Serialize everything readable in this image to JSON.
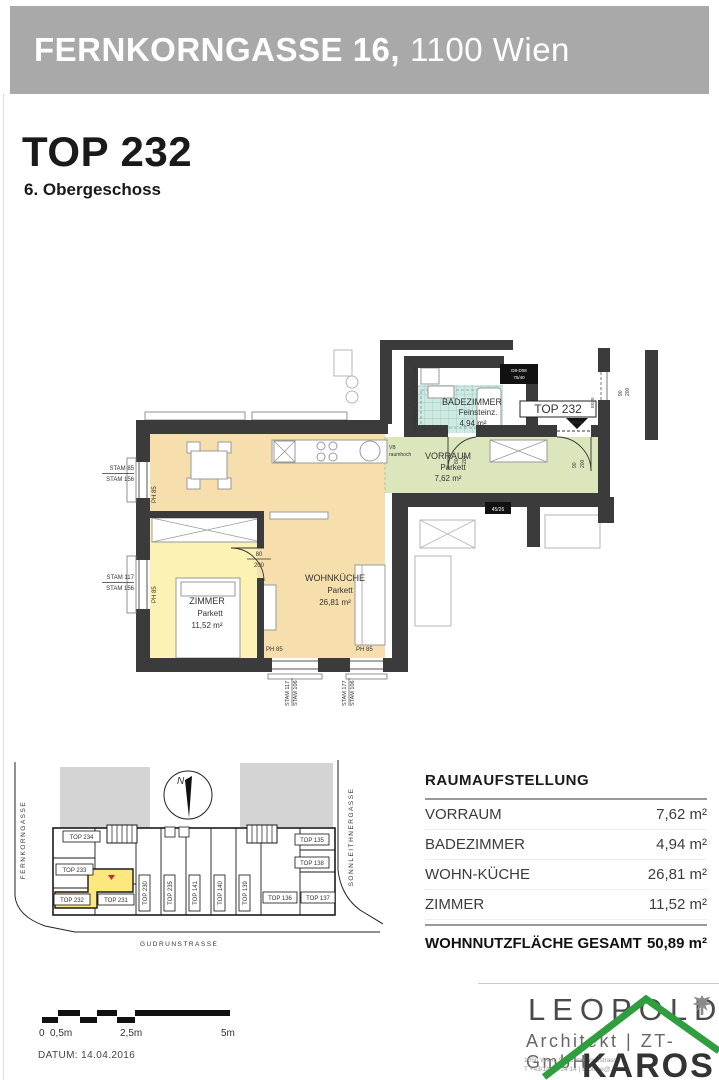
{
  "header": {
    "bar_bold": "FERNKORNGASSE 16,",
    "bar_light": "1100 Wien"
  },
  "title": {
    "unit": "TOP 232",
    "floor": "6. Obergeschoss"
  },
  "floorplan": {
    "rooms": {
      "wohnkueche": {
        "name": "WOHNKÜCHE",
        "finish": "Parkett",
        "area": "26,81 m²"
      },
      "zimmer": {
        "name": "ZIMMER",
        "finish": "Parkett",
        "area": "11,52 m²"
      },
      "vorraum": {
        "name": "VORRAUM",
        "finish": "Parkett",
        "area": "7,62 m²"
      },
      "badezimmer": {
        "name": "BADEZIMMER",
        "finish": "Feinsteinz.",
        "area": "4,94 m²"
      }
    },
    "entrance": {
      "label": "TOP 232",
      "code": "E030"
    },
    "dims": {
      "w80": "80",
      "w90": "90",
      "h200": "200"
    },
    "labels": {
      "stam85": "STAM 85",
      "stam156": "STAM 156",
      "stam117": "STAM 117",
      "stam177": "STAM 177",
      "stam106": "STAM 106",
      "ph85": "PH 85",
      "vb_line1": "VB",
      "vb_line2": "raumhoch",
      "verkleidung": "Verkleidung b=25 cm, UK +19,86",
      "dbox_line1": "D8-D08",
      "dbox_line2": "75/40",
      "shaft": "45/26"
    }
  },
  "siteplan": {
    "streets": {
      "left": "FERNKORNGASSE",
      "right": "SONNLEITHNERGASSE",
      "bottom": "GUDRUNSTRASSE"
    },
    "north": "N",
    "units": [
      "TOP 234",
      "TOP 233",
      "TOP 232",
      "TOP 231",
      "TOP 230",
      "TOP 235",
      "TOP 141",
      "TOP 140",
      "TOP 139",
      "TOP 136",
      "TOP 137",
      "TOP 135",
      "TOP 138"
    ]
  },
  "room_table": {
    "title": "RAUMAUFSTELLUNG",
    "rows": [
      {
        "label": "VORRAUM",
        "area": "7,62 m²"
      },
      {
        "label": "BADEZIMMER",
        "area": "4,94 m²"
      },
      {
        "label": "WOHN-KÜCHE",
        "area": "26,81 m²"
      },
      {
        "label": "ZIMMER",
        "area": "11,52 m²"
      }
    ],
    "total": {
      "label": "WOHNNUTZFLÄCHE GESAMT",
      "area": "50,89 m²"
    }
  },
  "scalebar": {
    "zero": "0",
    "half": "0,5m",
    "mid": "2,5m",
    "full": "5m"
  },
  "footer": {
    "date": "DATUM: 14.04.2016",
    "logo": "LEOPOLD",
    "logo_sub": "Architekt | ZT-GmbH",
    "addr_line1": "1050 Wien,   Schönbrunnerstrasse 2",
    "addr_line2": "T  +43/1/890 24 14   |   E  office@...zt.at",
    "watermark": "KAROS"
  }
}
